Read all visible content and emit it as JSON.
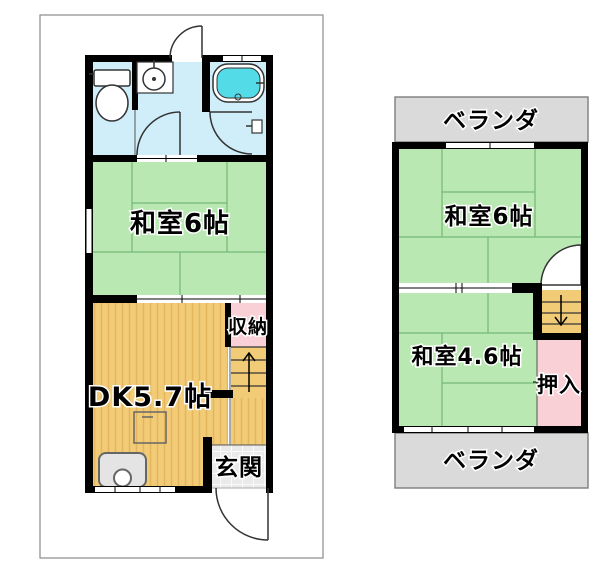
{
  "colors": {
    "wall": "#000000",
    "border_gray": "#8a8a8a",
    "tatami_green": "#b9e8b2",
    "tatami_line": "#74b874",
    "wood_orange": "#f2cb76",
    "wood_stripe": "#e2b55e",
    "water_blue": "#cfeef9",
    "tub_cyan": "#54dbe8",
    "closet_pink": "#f8d0d6",
    "veranda_gray": "#dadada",
    "tile_gray": "#eaeaea"
  },
  "floor1": {
    "rooms": {
      "washitsu6": {
        "label": "和室6帖"
      },
      "dk": {
        "label": "DK5.7帖"
      },
      "shunou": {
        "label": "収納"
      },
      "genkan": {
        "label": "玄関"
      }
    }
  },
  "floor2": {
    "veranda_top": {
      "label": "ベランダ"
    },
    "veranda_bottom": {
      "label": "ベランダ"
    },
    "rooms": {
      "washitsu6": {
        "label": "和室6帖"
      },
      "washitsu46": {
        "label": "和室4.6帖"
      },
      "oshiire": {
        "label": "押入"
      }
    }
  }
}
